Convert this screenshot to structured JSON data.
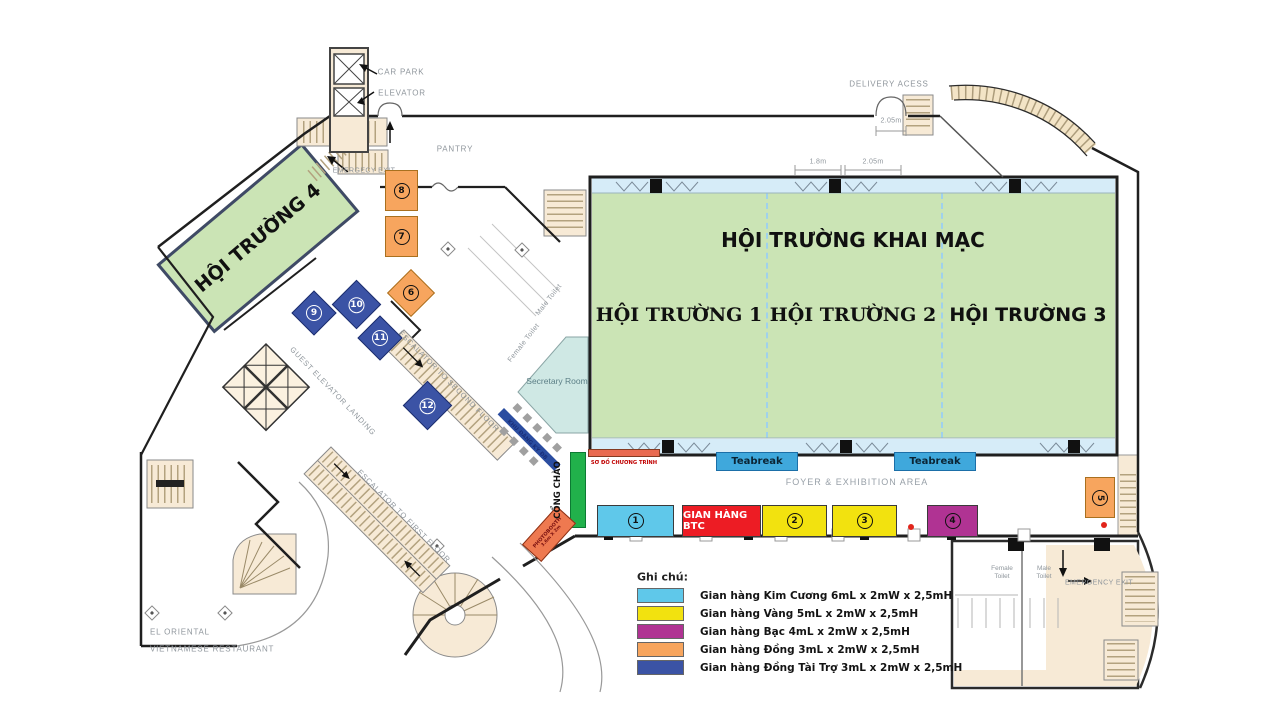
{
  "halls": {
    "hall4": "HỘI TRƯỜNG 4",
    "opening": "HỘI TRƯỜNG KHAI MẠC",
    "hall1": "HỘI TRƯỜNG 1",
    "hall2": "HỘI TRƯỜNG 2",
    "hall3": "HỘI TRƯỜNG 3"
  },
  "areas": {
    "secretary_room": "Secretary Room",
    "pantry": "PANTRY",
    "foyer": "FOYER & EXHIBITION AREA",
    "teabreak": "Teabreak",
    "gian_hang_btc": "GIAN HÀNG BTC",
    "cong_chao": "CỔNG CHÀO",
    "khu_dang_ky": "KHU ĐĂNG KÝ ĐB",
    "so_do_chuong_trinh": "SƠ ĐỒ CHƯƠNG TRÌNH",
    "photobooth": "PHOTOBOOTH",
    "photobooth_size": "3.6m X 2m",
    "restaurant_line1": "EL ORIENTAL",
    "restaurant_line2": "VIETNAMESE RESTAURANT"
  },
  "labels": {
    "car_park": "CAR PARK",
    "elevator": "ELEVATOR",
    "delivery_access": "DELIVERY ACESS",
    "emergency_exit_top": "EMERGECY EXIT",
    "emergency_exit_bottom": "EMERGENCY EXIT",
    "escalator_second": "ESCALATOR TO SECOND FLOOR",
    "escalator_first": "ESCALATOR TO FIRST FLOOR",
    "guest_elevator_landing": "GUEST ELEVATOR LANDING",
    "female_toilet": "Female Toilet",
    "male_toilet": "Male Toilet"
  },
  "measurements": {
    "delivery_door": "2.05m",
    "hall_door_left": "1.8m",
    "hall_door_right": "2.05m"
  },
  "booths": {
    "b1": "1",
    "b2": "2",
    "b3": "3",
    "b4": "4",
    "b5": "5",
    "b6": "6",
    "b7": "7",
    "b8": "8",
    "b9": "9",
    "b10": "10",
    "b11": "11",
    "b12": "12"
  },
  "legend": {
    "title": "Ghi chú:",
    "items": [
      {
        "label": "Gian hàng Kim Cương 6mL x 2mW x 2,5mH",
        "color": "#5fc8ea"
      },
      {
        "label": "Gian hàng Vàng 5mL x 2mW x 2,5mH",
        "color": "#f2e20f"
      },
      {
        "label": "Gian hàng Bạc 4mL x 2mW x 2,5mH",
        "color": "#b03393"
      },
      {
        "label": "Gian hàng Đồng 3mL x 2mW x 2,5mH",
        "color": "#f7a55e"
      },
      {
        "label": "Gian hàng Đồng Tài Trợ 3mL x 2mW x 2,5mH",
        "color": "#3b53a5"
      }
    ]
  },
  "colors": {
    "hall_green": "#cbe4b5",
    "band_blue": "#d6ecf8",
    "teabreak_blue": "#3fa8dc",
    "btc_red": "#ed1c24",
    "cong_chao_green": "#21b14b",
    "so_do_orange": "#e96a50",
    "photobooth_orange": "#ee7950",
    "orange": "#f7a55e",
    "sponsor_blue": "#3b53a5",
    "secretary_teal": "#cfe8e4"
  }
}
